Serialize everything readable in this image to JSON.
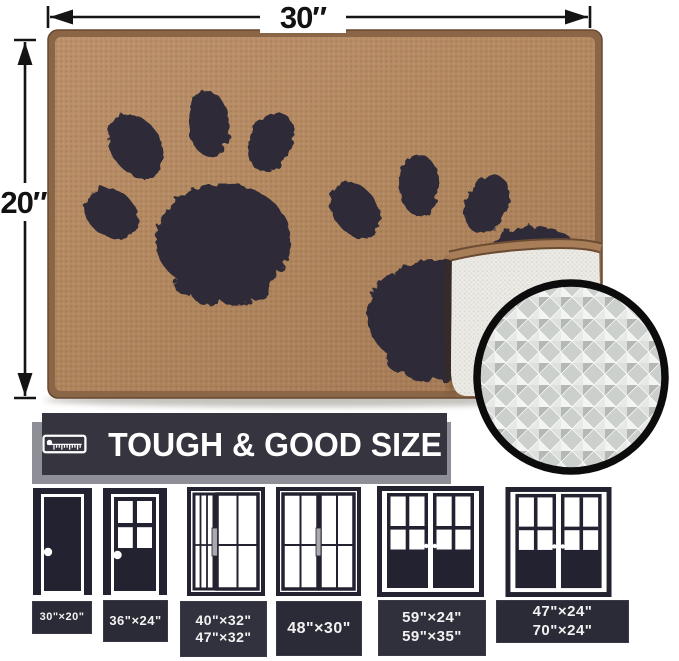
{
  "dimensions": {
    "width_label": "30″",
    "height_label": "20″"
  },
  "banner": {
    "label": "TOUGH & GOOD SIZE",
    "icon": "tape-measure-icon",
    "bg_color": "#35343f",
    "shadow_color": "#8e8e96"
  },
  "mat": {
    "description": "tan door mat with two dark paw prints, corner folded showing backing",
    "tan_color": "#b1875f",
    "trim_color": "#8a6647",
    "paw_color": "#2d2c37",
    "backing_color": "#eceae5",
    "inset_icon": "magnified-backing-texture",
    "inset_gray": "#ccd0cc"
  },
  "door_sizes": [
    {
      "door_type": "single-solid-door",
      "lines": [
        "30\"×20\""
      ]
    },
    {
      "door_type": "single-half-glass-door",
      "lines": [
        "36\"×24\""
      ]
    },
    {
      "door_type": "sliding-door-narrow-wide",
      "lines": [
        "40\"×32\"",
        "47\"×32\""
      ]
    },
    {
      "door_type": "sliding-door-equal-panels",
      "lines": [
        "48\"×30\""
      ]
    },
    {
      "door_type": "double-french-door",
      "lines": [
        "59\"×24\"",
        "59\"×35\""
      ]
    },
    {
      "door_type": "double-french-door-wide",
      "lines": [
        "47\"×24\"",
        "70\"×24\""
      ]
    }
  ]
}
